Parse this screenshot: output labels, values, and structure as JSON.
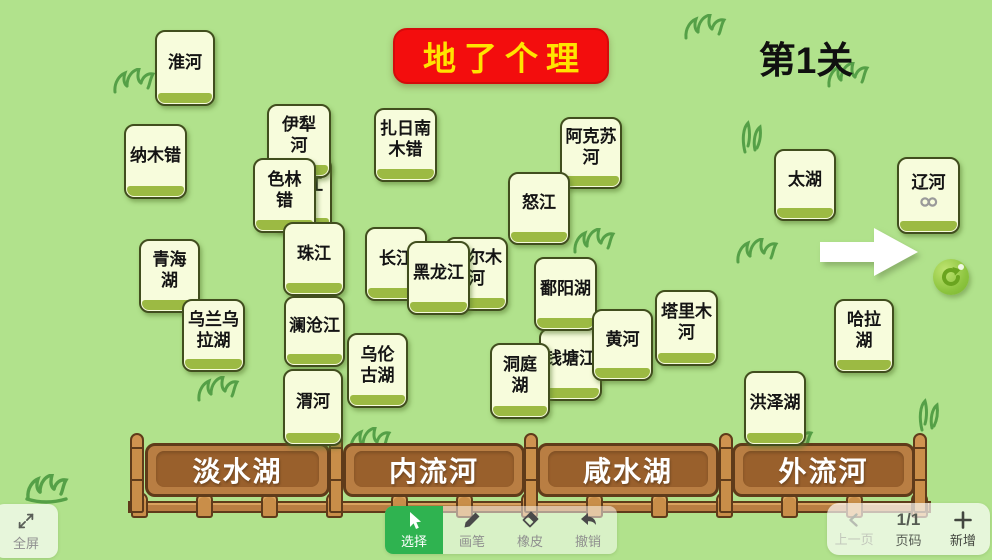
{
  "title": {
    "banner": "地了个理",
    "level": "第1关"
  },
  "colors": {
    "bg": "#b1e28c",
    "banner": "#f30d0d",
    "banner_text": "#ffe400",
    "card_fill": "#f7fcdc",
    "card_strip": "#9cba43",
    "wood": "#b97e43",
    "select_green": "#2fb350"
  },
  "cards": [
    {
      "name": "card-huaihe",
      "lines": [
        "淮河"
      ],
      "x": 155,
      "y": 30,
      "w": 60,
      "h": 76
    },
    {
      "name": "card-namucuo",
      "lines": [
        "纳木错"
      ],
      "x": 124,
      "y": 124,
      "w": 63,
      "h": 75
    },
    {
      "name": "card-jiang-partial",
      "lines": [
        "江"
      ],
      "x": 271,
      "y": 157,
      "w": 61,
      "h": 74,
      "variant": "peek-right"
    },
    {
      "name": "card-yilihe",
      "lines": [
        "伊犁",
        "河"
      ],
      "x": 267,
      "y": 104,
      "w": 64,
      "h": 74
    },
    {
      "name": "card-selincuo",
      "lines": [
        "色林",
        "错"
      ],
      "x": 253,
      "y": 158,
      "w": 63,
      "h": 75
    },
    {
      "name": "card-zharinanmucuo",
      "lines": [
        "扎日南",
        "木错"
      ],
      "x": 374,
      "y": 108,
      "w": 63,
      "h": 74
    },
    {
      "name": "card-akesuhe",
      "lines": [
        "阿克苏",
        "河"
      ],
      "x": 560,
      "y": 117,
      "w": 62,
      "h": 72
    },
    {
      "name": "card-nujiang",
      "lines": [
        "怒江"
      ],
      "x": 508,
      "y": 172,
      "w": 62,
      "h": 73
    },
    {
      "name": "card-taihu",
      "lines": [
        "太湖"
      ],
      "x": 774,
      "y": 149,
      "w": 62,
      "h": 72
    },
    {
      "name": "card-liaohe",
      "lines": [
        "辽河"
      ],
      "x": 897,
      "y": 157,
      "w": 63,
      "h": 77,
      "link_icon": true
    },
    {
      "name": "card-qinghaihu",
      "lines": [
        "青海",
        "湖"
      ],
      "x": 139,
      "y": 239,
      "w": 61,
      "h": 74
    },
    {
      "name": "card-wulanwulahu",
      "lines": [
        "乌兰乌",
        "拉湖"
      ],
      "x": 182,
      "y": 299,
      "w": 63,
      "h": 73
    },
    {
      "name": "card-zhujiang",
      "lines": [
        "珠江"
      ],
      "x": 283,
      "y": 222,
      "w": 62,
      "h": 74
    },
    {
      "name": "card-changjiang",
      "lines": [
        "长江"
      ],
      "x": 365,
      "y": 227,
      "w": 62,
      "h": 74
    },
    {
      "name": "card-geermuhe",
      "lines": [
        "格尔木",
        "河"
      ],
      "x": 445,
      "y": 237,
      "w": 63,
      "h": 74
    },
    {
      "name": "card-heilongjiang",
      "lines": [
        "黑龙江"
      ],
      "x": 407,
      "y": 241,
      "w": 63,
      "h": 74
    },
    {
      "name": "card-qiantangjiang",
      "lines": [
        "钱塘江"
      ],
      "x": 539,
      "y": 328,
      "w": 63,
      "h": 73
    },
    {
      "name": "card-poyanghu",
      "lines": [
        "鄱阳湖"
      ],
      "x": 534,
      "y": 257,
      "w": 63,
      "h": 74
    },
    {
      "name": "card-huanghe",
      "lines": [
        "黄河"
      ],
      "x": 592,
      "y": 309,
      "w": 61,
      "h": 72
    },
    {
      "name": "card-lancangjiang",
      "lines": [
        "澜沧江"
      ],
      "x": 284,
      "y": 296,
      "w": 61,
      "h": 71
    },
    {
      "name": "card-wulunguhu",
      "lines": [
        "乌伦",
        "古湖"
      ],
      "x": 347,
      "y": 333,
      "w": 61,
      "h": 75
    },
    {
      "name": "card-dongtinghu",
      "lines": [
        "洞庭",
        "湖"
      ],
      "x": 490,
      "y": 343,
      "w": 60,
      "h": 76
    },
    {
      "name": "card-talimuhe",
      "lines": [
        "塔里木",
        "河"
      ],
      "x": 655,
      "y": 290,
      "w": 63,
      "h": 76
    },
    {
      "name": "card-halahu",
      "lines": [
        "哈拉",
        "湖"
      ],
      "x": 834,
      "y": 299,
      "w": 60,
      "h": 74
    },
    {
      "name": "card-weihe",
      "lines": [
        "渭河"
      ],
      "x": 283,
      "y": 369,
      "w": 60,
      "h": 77
    },
    {
      "name": "card-hongzehu",
      "lines": [
        "洪泽湖"
      ],
      "x": 744,
      "y": 371,
      "w": 62,
      "h": 75
    }
  ],
  "bins": [
    {
      "name": "bin-freshwater-lake",
      "label": "淡水湖",
      "x": 145,
      "w": 185
    },
    {
      "name": "bin-inland-river",
      "label": "内流河",
      "x": 343,
      "w": 182
    },
    {
      "name": "bin-salt-lake",
      "label": "咸水湖",
      "x": 537,
      "w": 182
    },
    {
      "name": "bin-outflow-river",
      "label": "外流河",
      "x": 732,
      "w": 183
    }
  ],
  "toolbar": {
    "fullscreen": "全屏",
    "select": "选择",
    "pen": "画笔",
    "eraser": "橡皮",
    "undo": "撤销"
  },
  "pager": {
    "prev": "上一页",
    "page_value": "1/1",
    "page_label": "页码",
    "add": "新增"
  }
}
